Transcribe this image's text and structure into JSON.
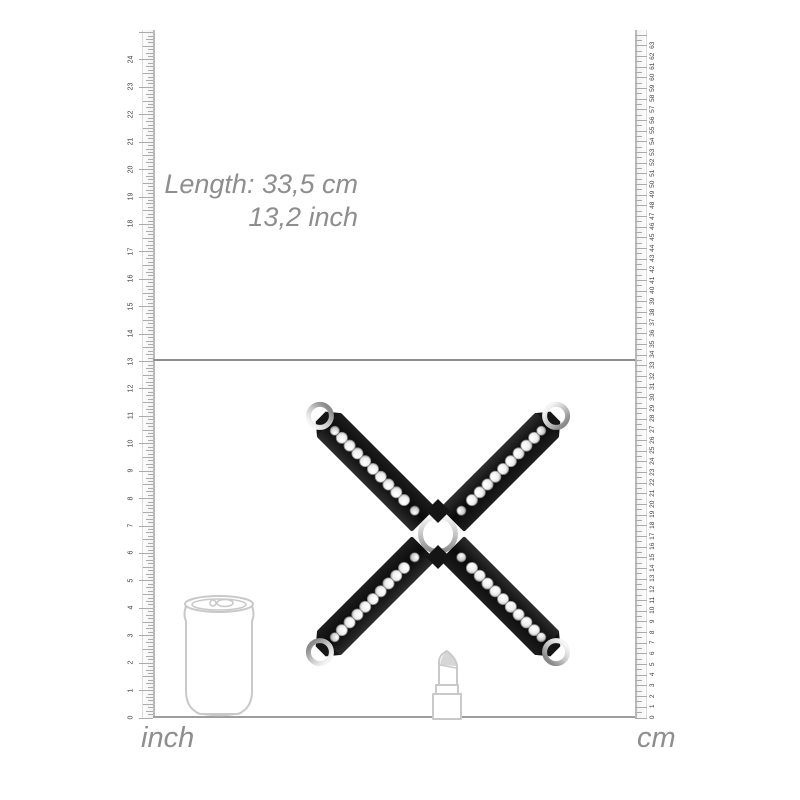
{
  "measurement": {
    "line1": "Length: 33,5 cm",
    "line2": "13,2 inch",
    "length_cm": "33,5",
    "length_inch": "13,2"
  },
  "rulers": {
    "inch": {
      "label": "inch",
      "min": 0,
      "max": 24,
      "subdivisions_per_unit": 8
    },
    "cm": {
      "label": "cm",
      "min": 0,
      "max": 63,
      "subdivisions_per_unit": 2
    }
  },
  "product": {
    "name": "black studded hogtie cross with snap hooks",
    "straps": 4,
    "rhinestones_per_strap": 9,
    "rivets_per_strap": 2,
    "snap_hooks": 4,
    "colors": {
      "strap": "#151515",
      "metal_light": "#f5f5f5",
      "metal_dark": "#8a8a8a",
      "stone": "#efefef"
    }
  },
  "reference_objects": [
    {
      "name": "soda-can"
    },
    {
      "name": "lipstick"
    }
  ],
  "colors": {
    "ruler_tick": "#ababab",
    "ruler_number": "#3c3c3c",
    "guide_line": "#8f8f8f",
    "baseline": "#9e9e9e",
    "label_text": "#8e8e8e",
    "outline": "#c9c9c9"
  }
}
